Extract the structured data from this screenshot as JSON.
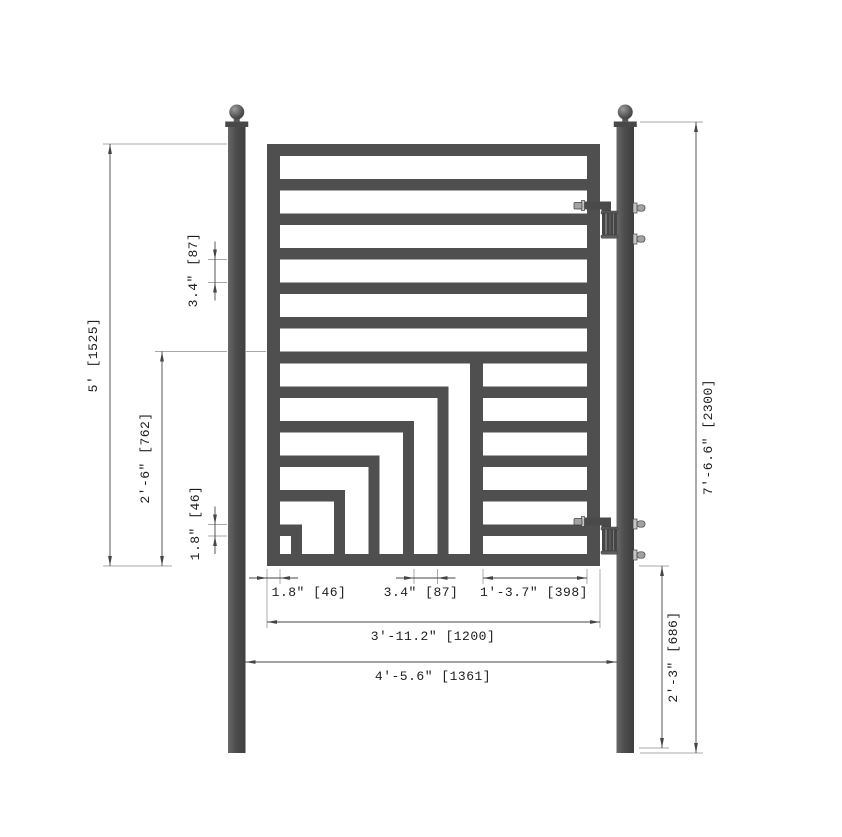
{
  "drawing": {
    "type": "technical-drawing",
    "subject": "single swing metal gate elevation with nested square design and dimension annotations",
    "canvas": {
      "width": 842,
      "height": 837,
      "background": "#ffffff"
    },
    "colors": {
      "steel": "#4f4f4f",
      "steel_dark": "#3e3e3e",
      "steel_mid": "#4a4a4a",
      "cap": "#484848",
      "hardware_light": "#c6c6c6",
      "hardware_mid": "#a2a2a2",
      "ext_line": "#a8a8a8",
      "dim_line": "#454545",
      "text": "#1d1d1d"
    },
    "posts": {
      "member_width": 17.5,
      "top_y": 127,
      "bottom_y": 753,
      "cap_height": 5.5,
      "ball_radius": 7.5,
      "ball_cy": 112,
      "left_x": 228,
      "right_x": 616.5
    },
    "gate": {
      "x": 267,
      "y": 144,
      "width": 333,
      "height": 422,
      "rail_thickness": 12,
      "stile_thickness": 13,
      "bar_thickness": 11.5,
      "upper_bar_ys": [
        179,
        213.5,
        248,
        282.5,
        317
      ],
      "separator": {
        "y": 351.5,
        "h": 12
      },
      "lower_rows": [
        {
          "y": 386.5,
          "left_end": 448.5
        },
        {
          "y": 421,
          "left_end": 414
        },
        {
          "y": 455.5,
          "left_end": 379.5
        },
        {
          "y": 490,
          "left_end": 345
        },
        {
          "y": 524.5,
          "left_end": 302
        }
      ],
      "bracket_verticals": [
        {
          "x": 437.5,
          "top": 386.5
        },
        {
          "x": 403,
          "top": 421
        },
        {
          "x": 368.5,
          "top": 455.5
        },
        {
          "x": 334,
          "top": 490
        },
        {
          "x": 291,
          "top": 524.5
        }
      ],
      "vertical_width": 11,
      "divider": {
        "x": 470,
        "w": 13,
        "top": 351.5
      },
      "right_bars_x": 483
    },
    "hinges": {
      "arm_top_ys": [
        201.5,
        517.5
      ]
    },
    "dimensions": [
      {
        "id": "gate-height",
        "label": "5' [1525]",
        "orient": "v",
        "x": 110,
        "from": 144,
        "to": 566,
        "arrows": "inside",
        "ext": [
          [
            103,
            144,
            227,
            144
          ],
          [
            103,
            566,
            172,
            566
          ]
        ],
        "text": {
          "x": 97,
          "y": 355
        }
      },
      {
        "id": "lower-section-height",
        "label": "2'-6\" [762]",
        "orient": "v",
        "x": 162,
        "from": 351.5,
        "to": 566,
        "arrows": "inside",
        "ext": [
          [
            155,
            351.5,
            227,
            351.5
          ],
          [
            246,
            351.5,
            266,
            351.5
          ]
        ],
        "text": {
          "x": 149,
          "y": 458
        }
      },
      {
        "id": "member-size-left",
        "label": "1.8\" [46]",
        "orient": "v",
        "x": 215,
        "from": 524.5,
        "to": 536,
        "arrows": "outside",
        "ext": [
          [
            208,
            524.5,
            227,
            524.5
          ],
          [
            208,
            536,
            227,
            536
          ]
        ],
        "text": {
          "x": 199,
          "y": 523
        }
      },
      {
        "id": "bar-spacing-left",
        "label": "3.4\" [87]",
        "orient": "v",
        "x": 215,
        "from": 259.5,
        "to": 282.5,
        "arrows": "outside",
        "ext": [
          [
            208,
            259.5,
            227,
            259.5
          ],
          [
            208,
            282.5,
            227,
            282.5
          ]
        ],
        "text": {
          "x": 197,
          "y": 270
        }
      },
      {
        "id": "member-size-bottom",
        "label": "1.8\" [46]",
        "orient": "h",
        "y": 578,
        "from": 267,
        "to": 280,
        "arrows": "outside",
        "ext": [
          [
            267,
            569,
            267,
            628
          ],
          [
            280,
            569,
            280,
            584
          ]
        ],
        "text": {
          "x": 309,
          "y": 596
        }
      },
      {
        "id": "bar-spacing-bottom",
        "label": "3.4\" [87]",
        "orient": "h",
        "y": 578,
        "from": 414,
        "to": 437.5,
        "arrows": "outside",
        "ext": [
          [
            414,
            569,
            414,
            584
          ],
          [
            437.5,
            569,
            437.5,
            584
          ]
        ],
        "text": {
          "x": 421,
          "y": 596
        }
      },
      {
        "id": "right-panel-width",
        "label": "1'-3.7\" [398]",
        "orient": "h",
        "y": 578,
        "from": 483,
        "to": 587,
        "arrows": "inside",
        "ext": [
          [
            483,
            569,
            483,
            584
          ],
          [
            587,
            569,
            587,
            584
          ]
        ],
        "text": {
          "x": 534,
          "y": 596
        }
      },
      {
        "id": "gate-width",
        "label": "3'-11.2\" [1200]",
        "orient": "h",
        "y": 622,
        "from": 267,
        "to": 600,
        "arrows": "inside",
        "ext": [
          [
            600,
            569,
            600,
            628
          ]
        ],
        "text": {
          "x": 433,
          "y": 640
        }
      },
      {
        "id": "post-spacing",
        "label": "4'-5.6\" [1361]",
        "orient": "h",
        "y": 662,
        "from": 245.5,
        "to": 616.5,
        "arrows": "inside",
        "ext": [],
        "text": {
          "x": 433,
          "y": 680
        }
      },
      {
        "id": "post-height",
        "label": "7'-6.6\" [2300]",
        "orient": "v",
        "x": 696,
        "from": 122,
        "to": 753,
        "arrows": "inside",
        "ext": [
          [
            640,
            122,
            703,
            122
          ],
          [
            640,
            753,
            703,
            753
          ]
        ],
        "text": {
          "x": 712,
          "y": 437
        }
      },
      {
        "id": "gate-to-ground",
        "label": "2'-3\" [686]",
        "orient": "v",
        "x": 662,
        "from": 566,
        "to": 748,
        "arrows": "inside",
        "ext": [
          [
            639,
            566,
            669,
            566
          ],
          [
            639,
            748,
            669,
            748
          ]
        ],
        "text": {
          "x": 677,
          "y": 657
        }
      }
    ]
  }
}
